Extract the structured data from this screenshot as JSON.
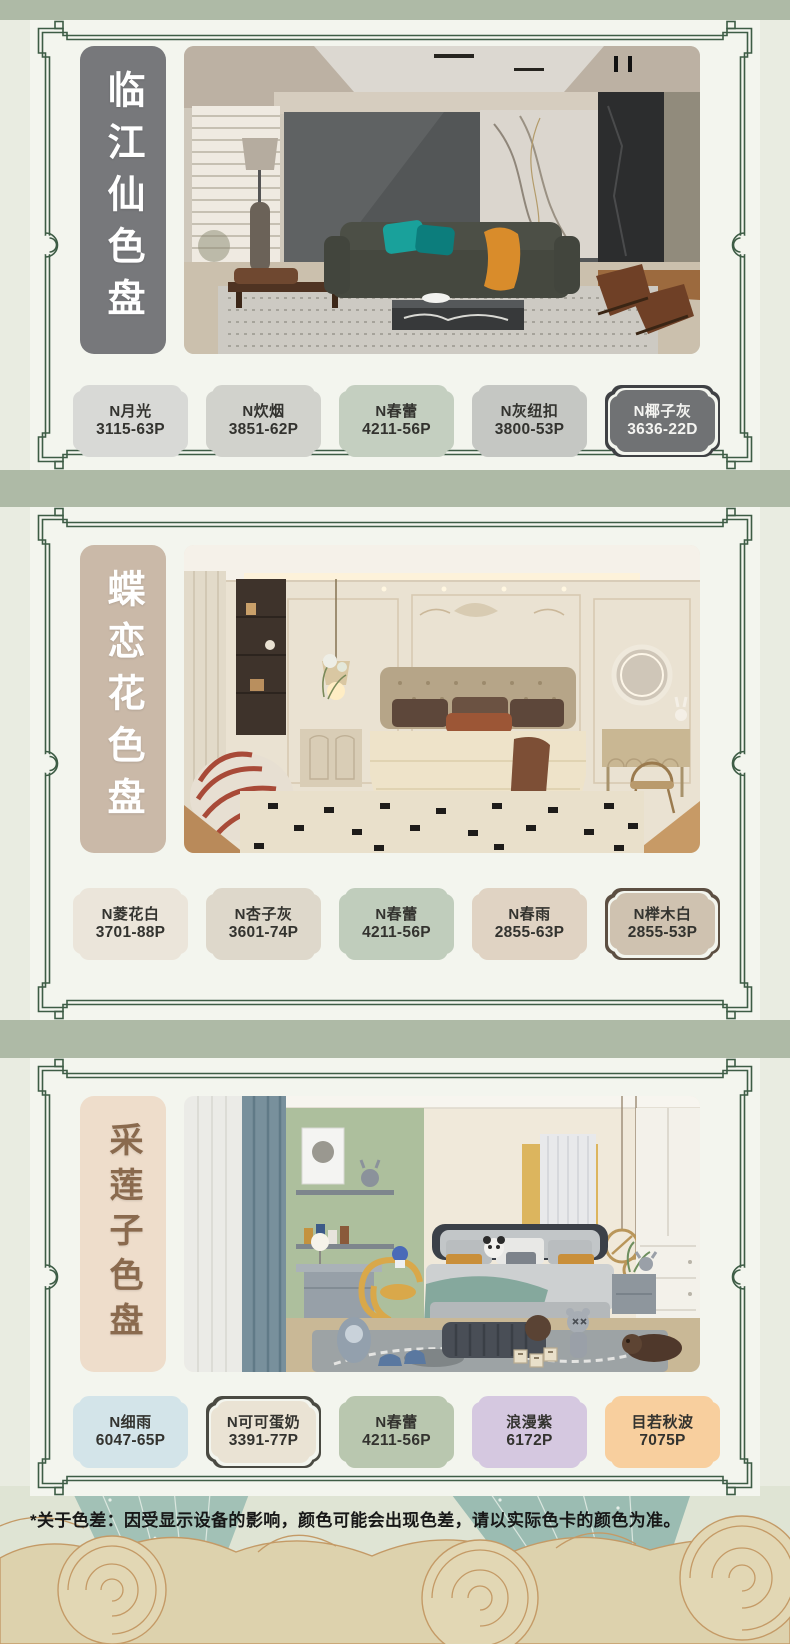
{
  "page": {
    "background": "#e9ece1",
    "band_color": "#aebaa6",
    "card_color": "#f3f5ee",
    "frame_color": "#3d5c45",
    "disclaimer": "*关于色差：因受显示设备的影响，颜色可能会出现色差，请以实际色卡的颜色为准。"
  },
  "sections": [
    {
      "title": "临江仙色盘",
      "label_bg": "#77787b",
      "label_fg": "#ffffff",
      "swatches": [
        {
          "name": "N月光",
          "code": "3115-63P",
          "fill": "#d8d9d6",
          "fg": "#33332f"
        },
        {
          "name": "N炊烟",
          "code": "3851-62P",
          "fill": "#d1d2cc",
          "fg": "#33332f"
        },
        {
          "name": "N春蕾",
          "code": "4211-56P",
          "fill": "#c4cfc0",
          "fg": "#33332f"
        },
        {
          "name": "N灰纽扣",
          "code": "3800-53P",
          "fill": "#c5c7c3",
          "fg": "#33332f"
        },
        {
          "name": "N椰子灰",
          "code": "3636-22D",
          "fill": "#707274",
          "fg": "#f4f4f1",
          "border": "#3f4144"
        }
      ]
    },
    {
      "title": "蝶恋花色盘",
      "label_bg": "#cab9a8",
      "label_fg": "#ffffff",
      "swatches": [
        {
          "name": "N菱花白",
          "code": "3701-88P",
          "fill": "#ebe5da",
          "fg": "#33332f"
        },
        {
          "name": "N杏子灰",
          "code": "3601-74P",
          "fill": "#ded8cb",
          "fg": "#33332f"
        },
        {
          "name": "N春蕾",
          "code": "4211-56P",
          "fill": "#c0cdbc",
          "fg": "#33332f"
        },
        {
          "name": "N春雨",
          "code": "2855-63P",
          "fill": "#e0d3c3",
          "fg": "#33332f"
        },
        {
          "name": "N榉木白",
          "code": "2855-53P",
          "fill": "#cfc2b0",
          "fg": "#33332f",
          "border": "#5c4f42"
        }
      ]
    },
    {
      "title": "采莲子色盘",
      "label_bg": "#eeddcb",
      "label_fg": "#8a6a4e",
      "swatches": [
        {
          "name": "N细雨",
          "code": "6047-65P",
          "fill": "#d3e4e9",
          "fg": "#33332f"
        },
        {
          "name": "N可可蛋奶",
          "code": "3391-77P",
          "fill": "#eae3d4",
          "fg": "#33332f",
          "border": "#4a4a42"
        },
        {
          "name": "N春蕾",
          "code": "4211-56P",
          "fill": "#b9c7af",
          "fg": "#33332f"
        },
        {
          "name": "浪漫紫",
          "code": "6172P",
          "fill": "#d5c8e0",
          "fg": "#33332f"
        },
        {
          "name": "目若秋波",
          "code": "7075P",
          "fill": "#f8cf9e",
          "fg": "#33332f"
        }
      ]
    }
  ]
}
